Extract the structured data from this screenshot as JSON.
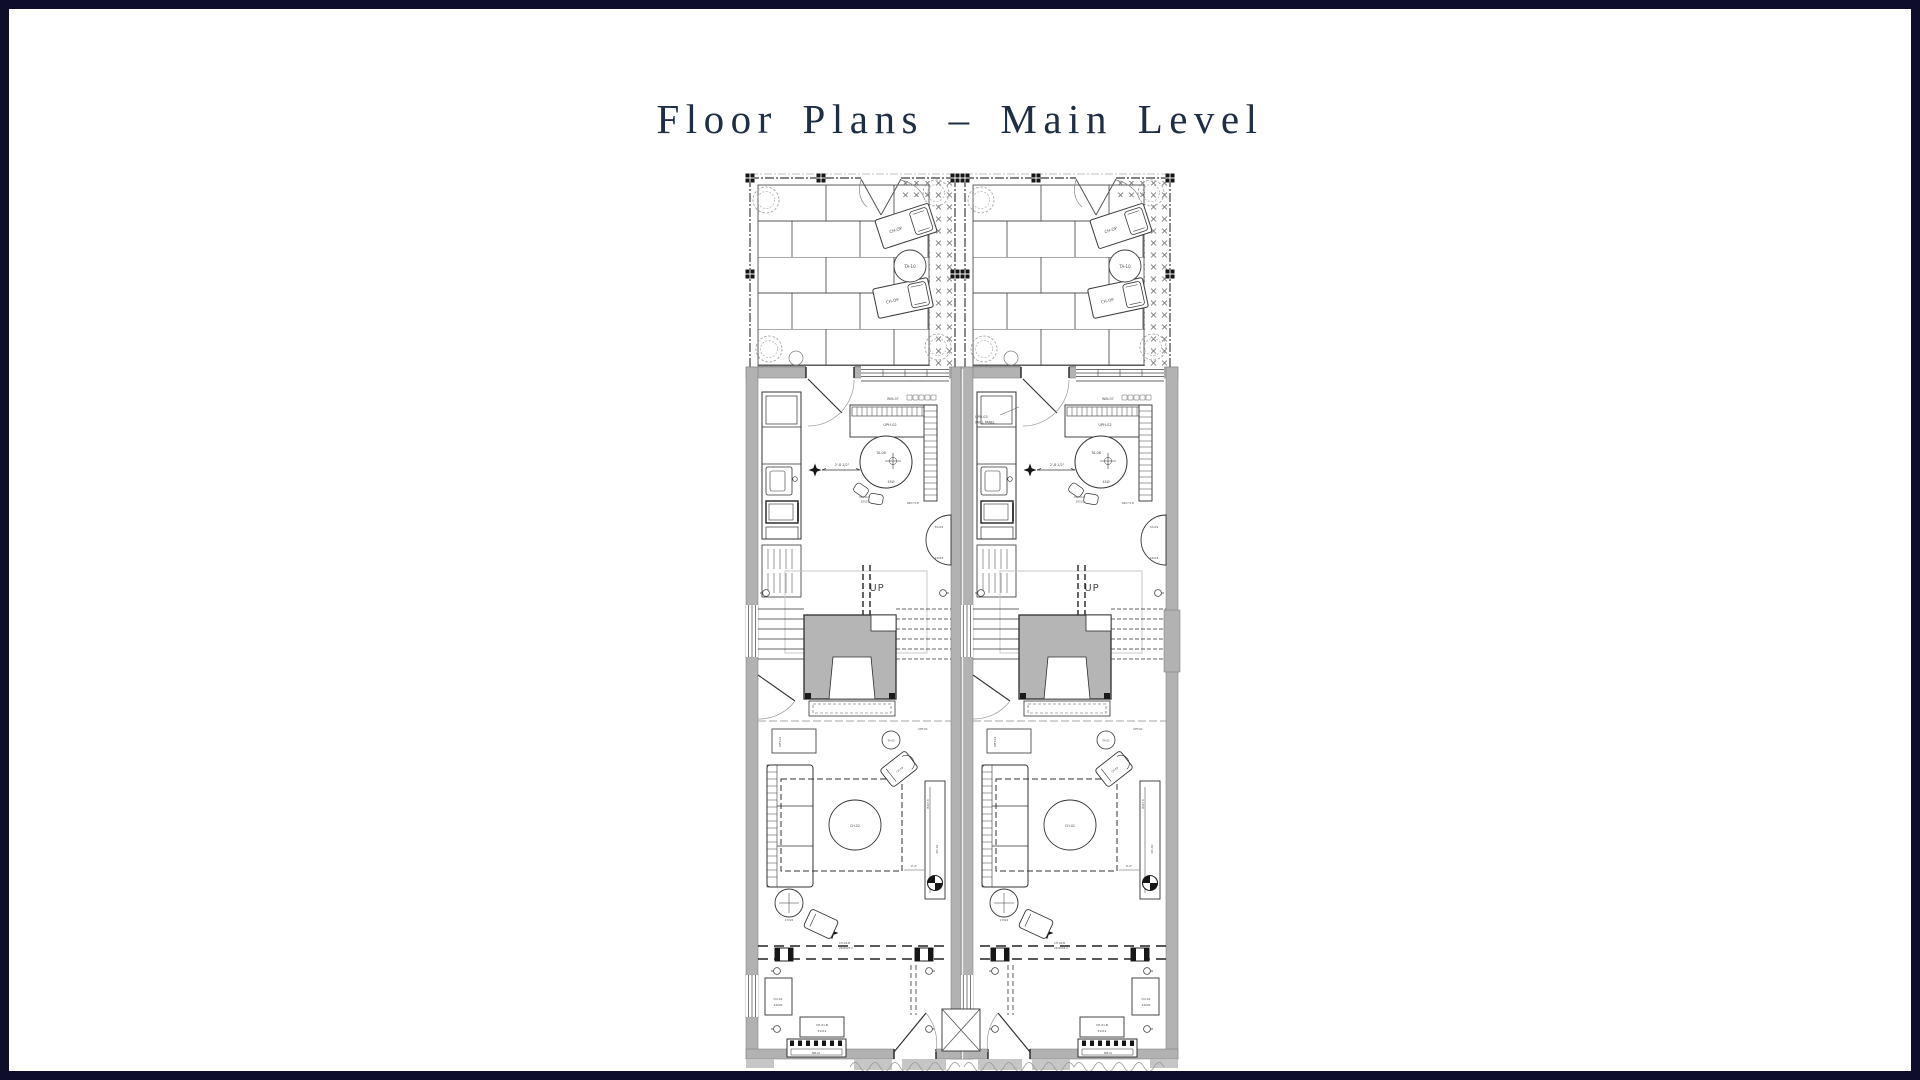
{
  "page": {
    "border_color": "#0e0e2c",
    "background": "#ffffff"
  },
  "title": "Floor Plans – Main Level",
  "plan": {
    "colors": {
      "line": "#3c3c3c",
      "wall_fill": "#b2b2b2",
      "stair_mass": "#b5b5b5",
      "light_line": "#9b9b9b"
    },
    "labels": {
      "patio_chair": "CH-OP",
      "patio_table": "TA-10",
      "window": "WIN-07",
      "banquette": "UPH-02",
      "wall_panel_line1": "UPH-03",
      "wall_panel_line2": "WALL PANEL",
      "dining_table": "TA-06",
      "dining_table_dia": "45Ø",
      "dining_dim": "2'-8 1/2\"",
      "dining_note1": "PLN-04B",
      "dining_note2": "25X22",
      "shelf": "84X7.5.B",
      "side_table": "TA-09",
      "side_table_size": "24X18",
      "stairs_up": "UP",
      "carpet": "CPT-01",
      "sofa": "UPH-01",
      "sofa_table": "TA-03",
      "lounge_chair": "CH-03",
      "coffee_table": "CH-02",
      "console_size": "B4X7.8",
      "console": "CO-02",
      "corner_table_size": "17X24",
      "accent_chair": "CH-02-B",
      "accent_chair_size": "26.8X23.2",
      "living_dim": "0'-0\"",
      "entry_console": "CO-01",
      "entry_console_size": "24X20",
      "entry_bench": "CH-01-B",
      "entry_bench_size": "31X14",
      "entry_shoe": "WB-01"
    }
  }
}
